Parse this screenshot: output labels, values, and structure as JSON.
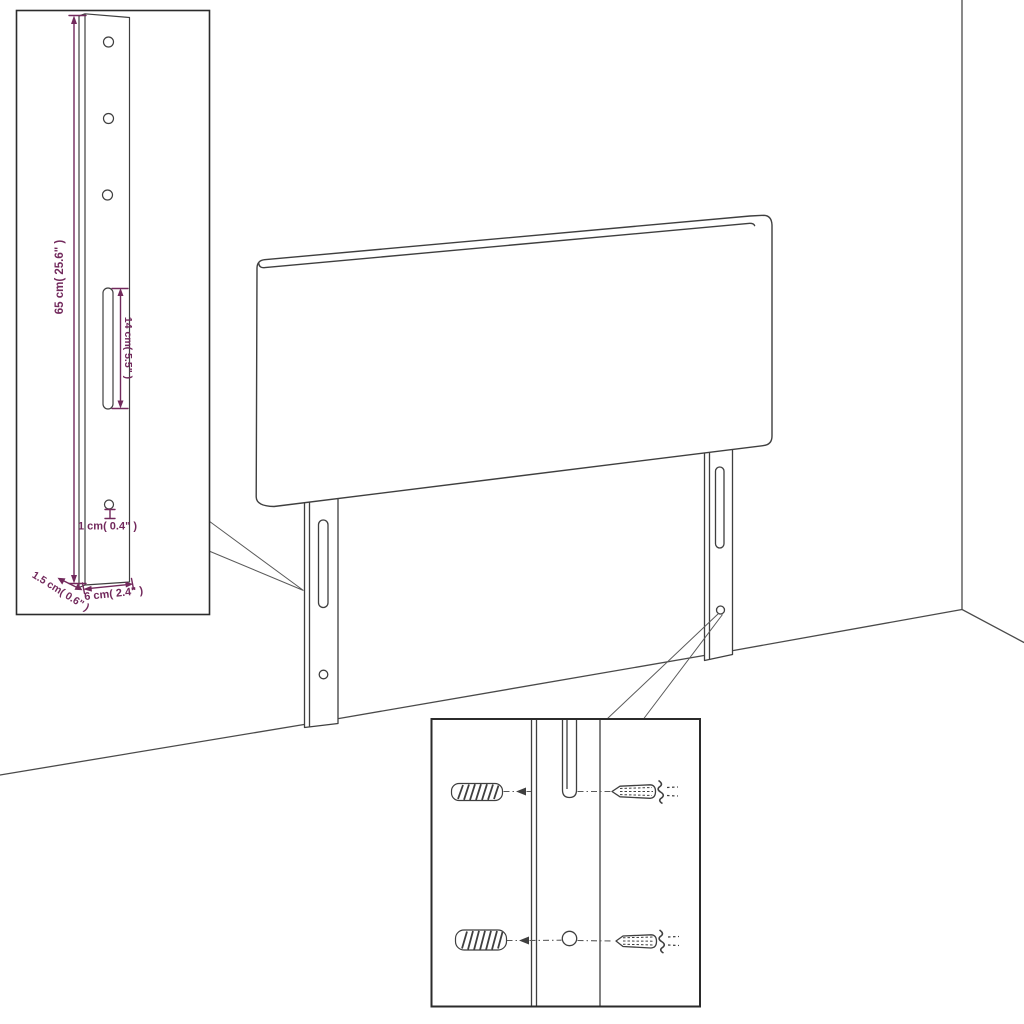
{
  "colors": {
    "dimension": "#72295c",
    "line": "#3f3f3f",
    "wall": "#4a4a4a",
    "callout": "#5a5a5a",
    "inset_border": "#2b2b2b",
    "background": "#ffffff"
  },
  "insets": {
    "leg_detail": {
      "labels": {
        "height": "65 cm( 25.6\" )",
        "slot_height": "14 cm( 5.5\" )",
        "hole_diameter": "1 cm( 0.4\" )",
        "thickness": "1.5 cm( 0.6\" )",
        "width": "6 cm( 2.4\" )"
      }
    },
    "mounting_detail": {
      "parts": {
        "wall_plug_top": "wall-plug",
        "wall_plug_bottom": "wall-plug",
        "screw_top": "screw",
        "screw_bottom": "screw"
      }
    }
  }
}
